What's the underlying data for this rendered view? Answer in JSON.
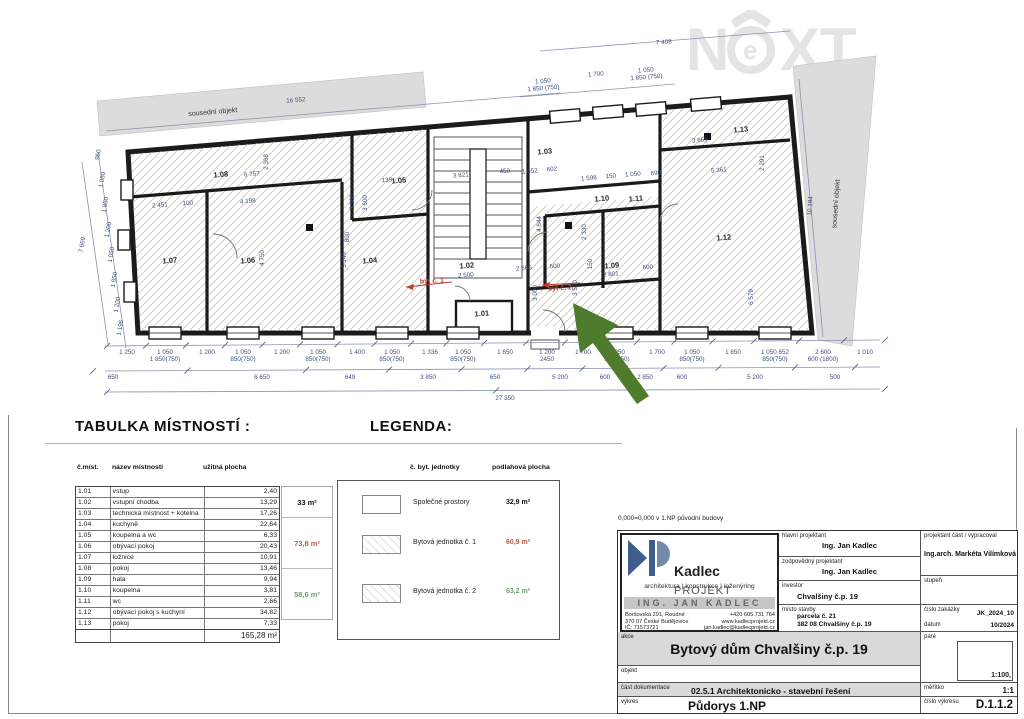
{
  "watermark": {
    "n": "N",
    "e": "e",
    "xt": "XT"
  },
  "colors": {
    "unit1": "#c0584a",
    "unit2": "#6fa06f",
    "dim": "#3d4f7c",
    "arrow": "#4f7b2c",
    "red_label": "#c03b2e"
  },
  "plan": {
    "neighbor_top": {
      "label": "sousední objekt",
      "dim": "16 552"
    },
    "neighbor_right": {
      "label": "sousední objekt",
      "dim": "10 194"
    },
    "rooms": [
      "1.01",
      "1.02",
      "1.03",
      "1.04",
      "1.05",
      "1.06",
      "1.07",
      "1.08",
      "1.09",
      "1.10",
      "1.11",
      "1.12",
      "1.13"
    ],
    "unit_labels": [
      "byt č. 1",
      "byt č. 2"
    ],
    "top_total_dim": "7 408",
    "top_window_dims": [
      [
        "1 050",
        "1 850 (750)"
      ],
      [
        "1 700",
        ""
      ],
      [
        "1 050",
        "1 850 (750)"
      ]
    ],
    "left_dims": [
      "950",
      "1 050",
      "1 850",
      "1 200",
      "1 050",
      "1 850",
      "1 200",
      "1 196"
    ],
    "left_total_dim": "7 669",
    "bottom_row1": [
      [
        "1 250",
        ""
      ],
      [
        "1 050",
        "1 850(750)"
      ],
      [
        "1 200",
        ""
      ],
      [
        "1 050",
        "850(750)"
      ],
      [
        "1 200",
        ""
      ],
      [
        "1 050",
        "850(750)"
      ],
      [
        "1 400",
        ""
      ],
      [
        "1 050",
        "850(750)"
      ],
      [
        "1 336",
        ""
      ],
      [
        "1 050",
        "850(750)"
      ],
      [
        "1 650",
        ""
      ],
      [
        "1 200",
        "2450"
      ],
      [
        "1 700",
        ""
      ],
      [
        "1 050",
        "850(750)"
      ],
      [
        "1 700",
        ""
      ],
      [
        "1 050",
        "850(750)"
      ],
      [
        "1 850",
        ""
      ],
      [
        "1 050 652",
        "850(750)"
      ],
      [
        "2 600",
        "600 (1800)"
      ],
      [
        "1 010",
        ""
      ]
    ],
    "bottom_row2": [
      "650",
      "6 650",
      "649",
      "3 850",
      "650",
      "5 200",
      "600",
      "2 850",
      "600",
      "5 200",
      "500"
    ],
    "bottom_total": "27 350",
    "inner_h_dims": [
      "6 757",
      "2 451",
      "100",
      "4 198",
      "139",
      "3 821",
      "450",
      "1 552",
      "602",
      "1 598",
      "150",
      "1 050",
      "698",
      "5 361",
      "3 669",
      "2 500",
      "2 665",
      "600",
      "2 801",
      "600"
    ],
    "inner_v_dims": [
      "2 368",
      "4 750",
      "3 146",
      "3 300",
      "3 600",
      "800",
      "4 644",
      "2 330",
      "150",
      "3 000",
      "3 500",
      "6 579",
      "2 291"
    ]
  },
  "room_table": {
    "title": "TABULKA MÍSTNOSTÍ :",
    "headers": {
      "no": "č.míst.",
      "name": "název místnosti",
      "area": "užitná plocha"
    },
    "rows": [
      {
        "no": "1.01",
        "name": "vstup",
        "area": "2,40"
      },
      {
        "no": "1.02",
        "name": "vstupní chodba",
        "area": "13,29"
      },
      {
        "no": "1.03",
        "name": "technická místnost + kotelna",
        "area": "17,26"
      },
      {
        "no": "1.04",
        "name": "kuchyně",
        "area": "22,64"
      },
      {
        "no": "1.05",
        "name": "koupelna a wc",
        "area": "6,33"
      },
      {
        "no": "1.06",
        "name": "obývací pokoj",
        "area": "20,43"
      },
      {
        "no": "1.07",
        "name": "ložnice",
        "area": "10,91"
      },
      {
        "no": "1.08",
        "name": "pokoj",
        "area": "13,46"
      },
      {
        "no": "1.09",
        "name": "hala",
        "area": "9,94"
      },
      {
        "no": "1.10",
        "name": "koupelna",
        "area": "3,81"
      },
      {
        "no": "1.11",
        "name": "wc",
        "area": "2,66"
      },
      {
        "no": "1.12",
        "name": "obývací pokoj s kuchyní",
        "area": "34,82"
      },
      {
        "no": "1.13",
        "name": "pokoj",
        "area": "7,33"
      }
    ],
    "total": "165,28 m²",
    "groups": [
      {
        "label": "33 m²",
        "color": "#111"
      },
      {
        "label": "73,8 m²",
        "color": "#c0584a"
      },
      {
        "label": "58,6 m²",
        "color": "#6fa06f"
      }
    ]
  },
  "legend": {
    "title": "LEGENDA:",
    "headers": {
      "col1": "č. byt. jednotky",
      "col2": "podlahová plocha"
    },
    "items": [
      {
        "label": "Společné prostory",
        "area": "32,9 m²",
        "color": "#111",
        "hatched": false
      },
      {
        "label": "Bytová jednotka č. 1",
        "area": "60,9 m²",
        "color": "#c0584a",
        "hatched": true
      },
      {
        "label": "Bytová jednotka č. 2",
        "area": "63,2 m²",
        "color": "#6fa06f",
        "hatched": true
      }
    ]
  },
  "titleblock": {
    "note": "0,000=0,000 v 1.NP původní budovy",
    "logo": {
      "brand": "Kadlec",
      "brand2": "PROJEKT",
      "tagline": "architektura | konstrukce | inženýring",
      "banner": "ING. JAN KADLEC",
      "addr": [
        [
          "Boršovská 291, Roudné",
          "+420 605 731 764"
        ],
        [
          "370 07 České Budějovice",
          "www.kadlecprojekt.cz"
        ],
        [
          "IČ: 71573721",
          "jan.kadlec@kadlecprojekt.cz"
        ]
      ]
    },
    "fields": {
      "hlavni_label": "hlavní projektant",
      "hlavni": "Ing. Jan Kadlec",
      "zodp_label": "zodpovědný projektant",
      "zodp": "Ing. Jan Kadlec",
      "investor_label": "investor",
      "investor": "Chvalšiny č.p. 19",
      "misto_label": "místo stavby",
      "misto1": "parcela č. 21",
      "misto2": "382 08 Chvalšiny č.p. 19",
      "proj_label": "projektant část / vypracoval",
      "proj": "Ing.arch. Markéta Vilímková",
      "stupen_label": "stupeň",
      "zakazka_label": "číslo zakázky",
      "zakazka": "JK_2024_10",
      "datum_label": "datum",
      "datum": "10/2024",
      "akce_label": "akce",
      "akce": "Bytový dům Chvalšiny č.p. 19",
      "objekt_label": "objekt",
      "cast_label": "část dokumentace",
      "cast": "02.5.1   Architektonicko - stavební řešení",
      "vykres_label": "výkres",
      "vykres": "Půdorys 1.NP",
      "pare_label": "paré",
      "pare_value": "1:100,",
      "meritko_label": "měřítko",
      "meritko": "1:1",
      "cislo_label": "číslo výkresu",
      "cislo": "D.1.1.2"
    }
  }
}
